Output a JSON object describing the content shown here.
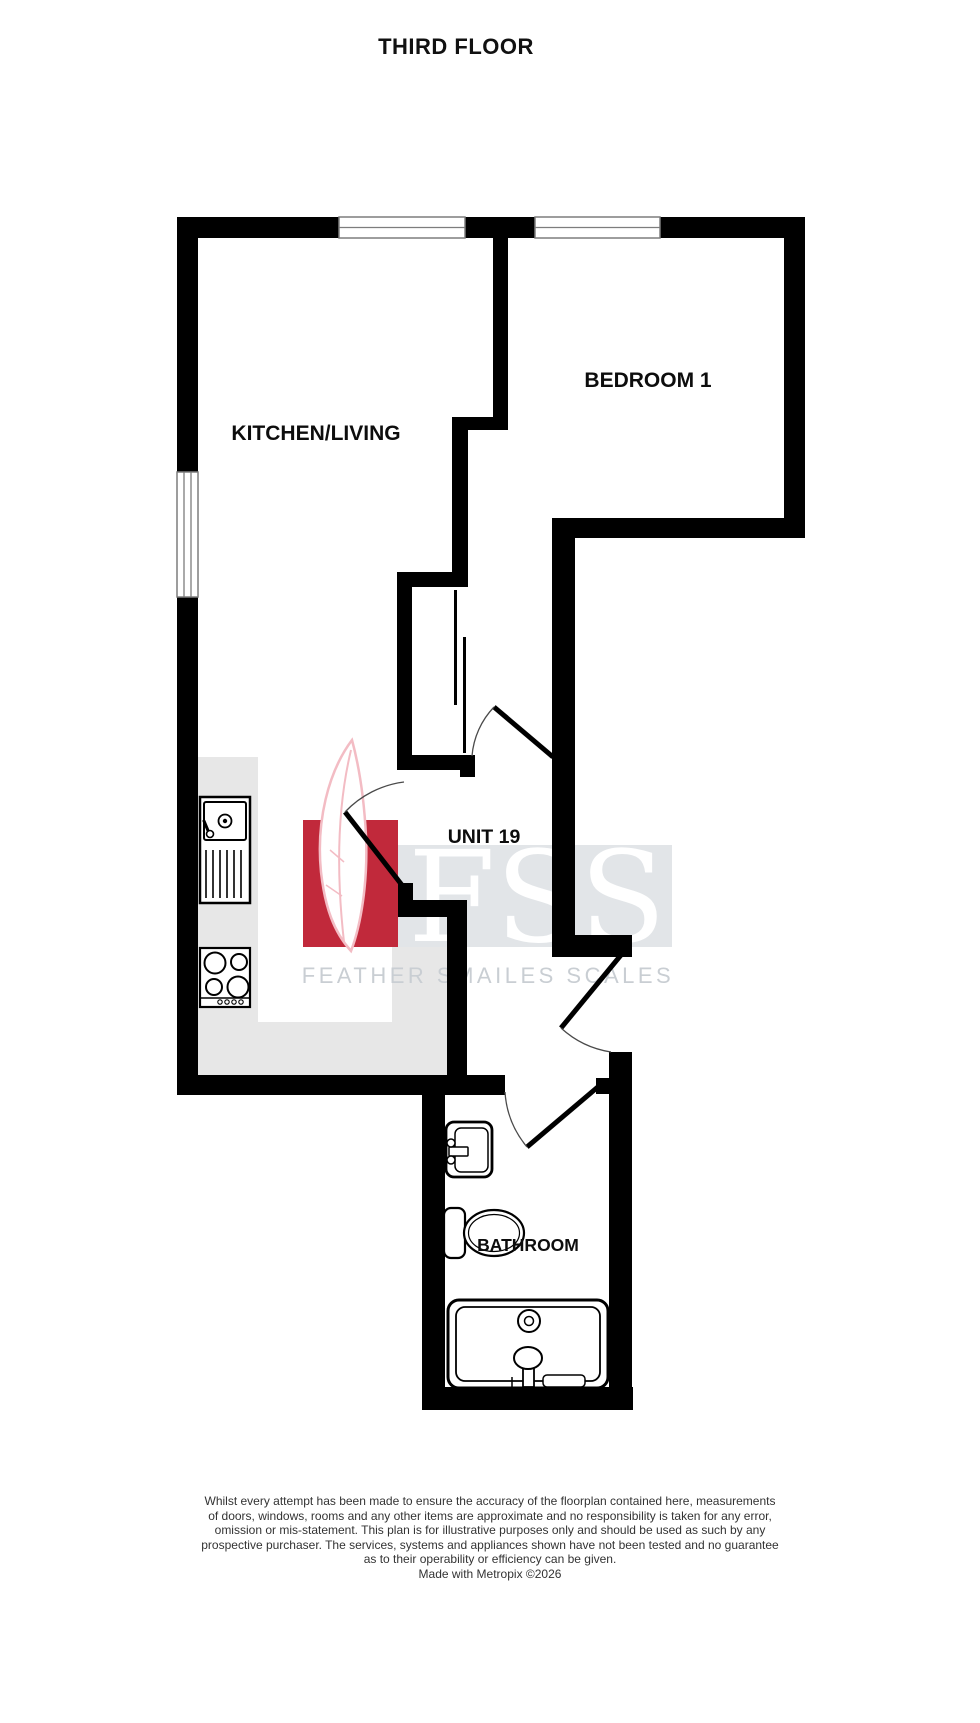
{
  "title": "THIRD FLOOR",
  "rooms": {
    "kitchen_living": "KITCHEN/LIVING",
    "bedroom": "BEDROOM 1",
    "unit": "UNIT 19",
    "bathroom": "BATHROOM"
  },
  "watermark": {
    "letters": "FSS",
    "caption": "FEATHER SMAILES SCALES"
  },
  "colors": {
    "wall": "#000000",
    "counter": "#e7e7e7",
    "watermark_box": "#e2e5e8",
    "watermark_red": "#c1293b",
    "watermark_text": "#c9ced3",
    "feather_outline": "#f3bcc4"
  },
  "footer": {
    "lines": [
      "Whilst every attempt has been made to ensure the accuracy of the floorplan contained here, measurements",
      "of doors, windows, rooms and any other items are approximate and no responsibility is taken for any error,",
      "omission or mis-statement. This plan is for illustrative purposes only and should be used as such by any",
      "prospective purchaser. The services, systems and appliances shown have not been tested and no guarantee",
      "as to their operability or efficiency can be given."
    ],
    "credit": "Made with Metropix ©2026"
  }
}
